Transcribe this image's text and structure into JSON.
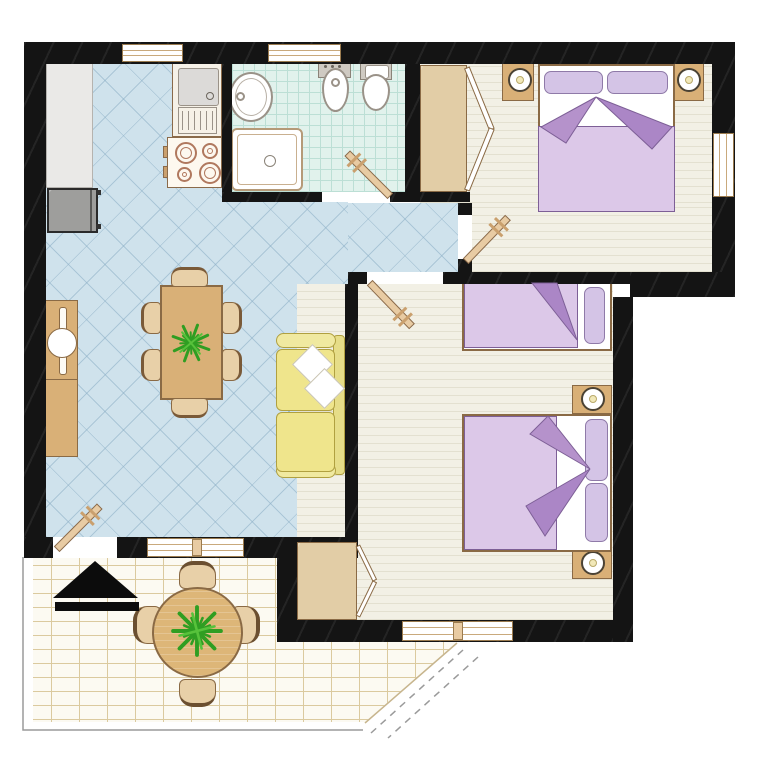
{
  "title": "apartment-floor-plan",
  "palette": {
    "wall": "#141414",
    "living": "#cfe2ec",
    "living_line": "rgba(140,175,198,0.55)",
    "bath": "#e1f2ec",
    "bath_line": "#bcdfd5",
    "bedroom": "#f2f0e5",
    "plank": "#e3e0d0",
    "terrace": "#fcfaf2",
    "mortar": "#dbca9f",
    "win_frame": "#9b7c50",
    "win_line": "#c9a97c",
    "wood": "#d9b077",
    "wood_dark": "#8a6a45",
    "wood_light": "#e2cda6",
    "chair": "#e8d0a8",
    "door": "#e8cba3",
    "door_edge": "#8a6a4a",
    "handle": "#caa06e",
    "sofa": "#f0e9a0",
    "sofa_seat": "#efe58c",
    "sofa_back": "#e6dd88",
    "sofa_edge": "#b0a040",
    "blanket": "#dcc8e8",
    "pillow": "#d4c4e6",
    "pillow_edge": "#8f7aa8",
    "fold_dark": "#ab86c6",
    "fold_light": "#b592cb",
    "fold_edge": "#7d5f96",
    "fixture_edge": "#9a9288",
    "counter": "#eae9e7",
    "fridge": "#9e9e9c",
    "burner": "#b0785e",
    "plant": "#2f9e22",
    "lamp": "#f1e8b8",
    "outline": "#9a9a9a",
    "arrow": "#0c0c0c"
  },
  "rooms": [
    {
      "id": "kitchen-living-room"
    },
    {
      "id": "bathroom"
    },
    {
      "id": "bedroom-1"
    },
    {
      "id": "bedroom-2"
    },
    {
      "id": "hallway"
    },
    {
      "id": "terrace"
    }
  ],
  "furniture": {
    "kitchen_living": [
      "kitchen-counter",
      "refrigerator",
      "kitchen-sink-drainer",
      "stove-4-burners",
      "sideboard",
      "dining-table",
      "dining-chairs-x6",
      "table-plant",
      "sofa",
      "sofa-pillows-x2"
    ],
    "bathroom": [
      "washbasin",
      "shower-tray",
      "bidet",
      "toilet"
    ],
    "bedroom_1": [
      "double-bed",
      "pillows-x2",
      "nightstand-left",
      "nightstand-right",
      "lamps-x2",
      "wardrobe-open"
    ],
    "bedroom_2": [
      "single-bed",
      "double-bed",
      "pillows",
      "nightstands-x2",
      "lamps-x2",
      "closet-open"
    ],
    "terrace": [
      "round-table",
      "terrace-chairs-x4",
      "table-plant",
      "entrance-arrow"
    ]
  },
  "openings": {
    "doors": [
      "entrance-door",
      "bathroom-door",
      "bedroom-1-door",
      "bedroom-2-door"
    ],
    "windows": [
      "kitchen-window",
      "bathroom-window",
      "bedroom-1-window",
      "living-room-window",
      "bedroom-2-window"
    ]
  }
}
